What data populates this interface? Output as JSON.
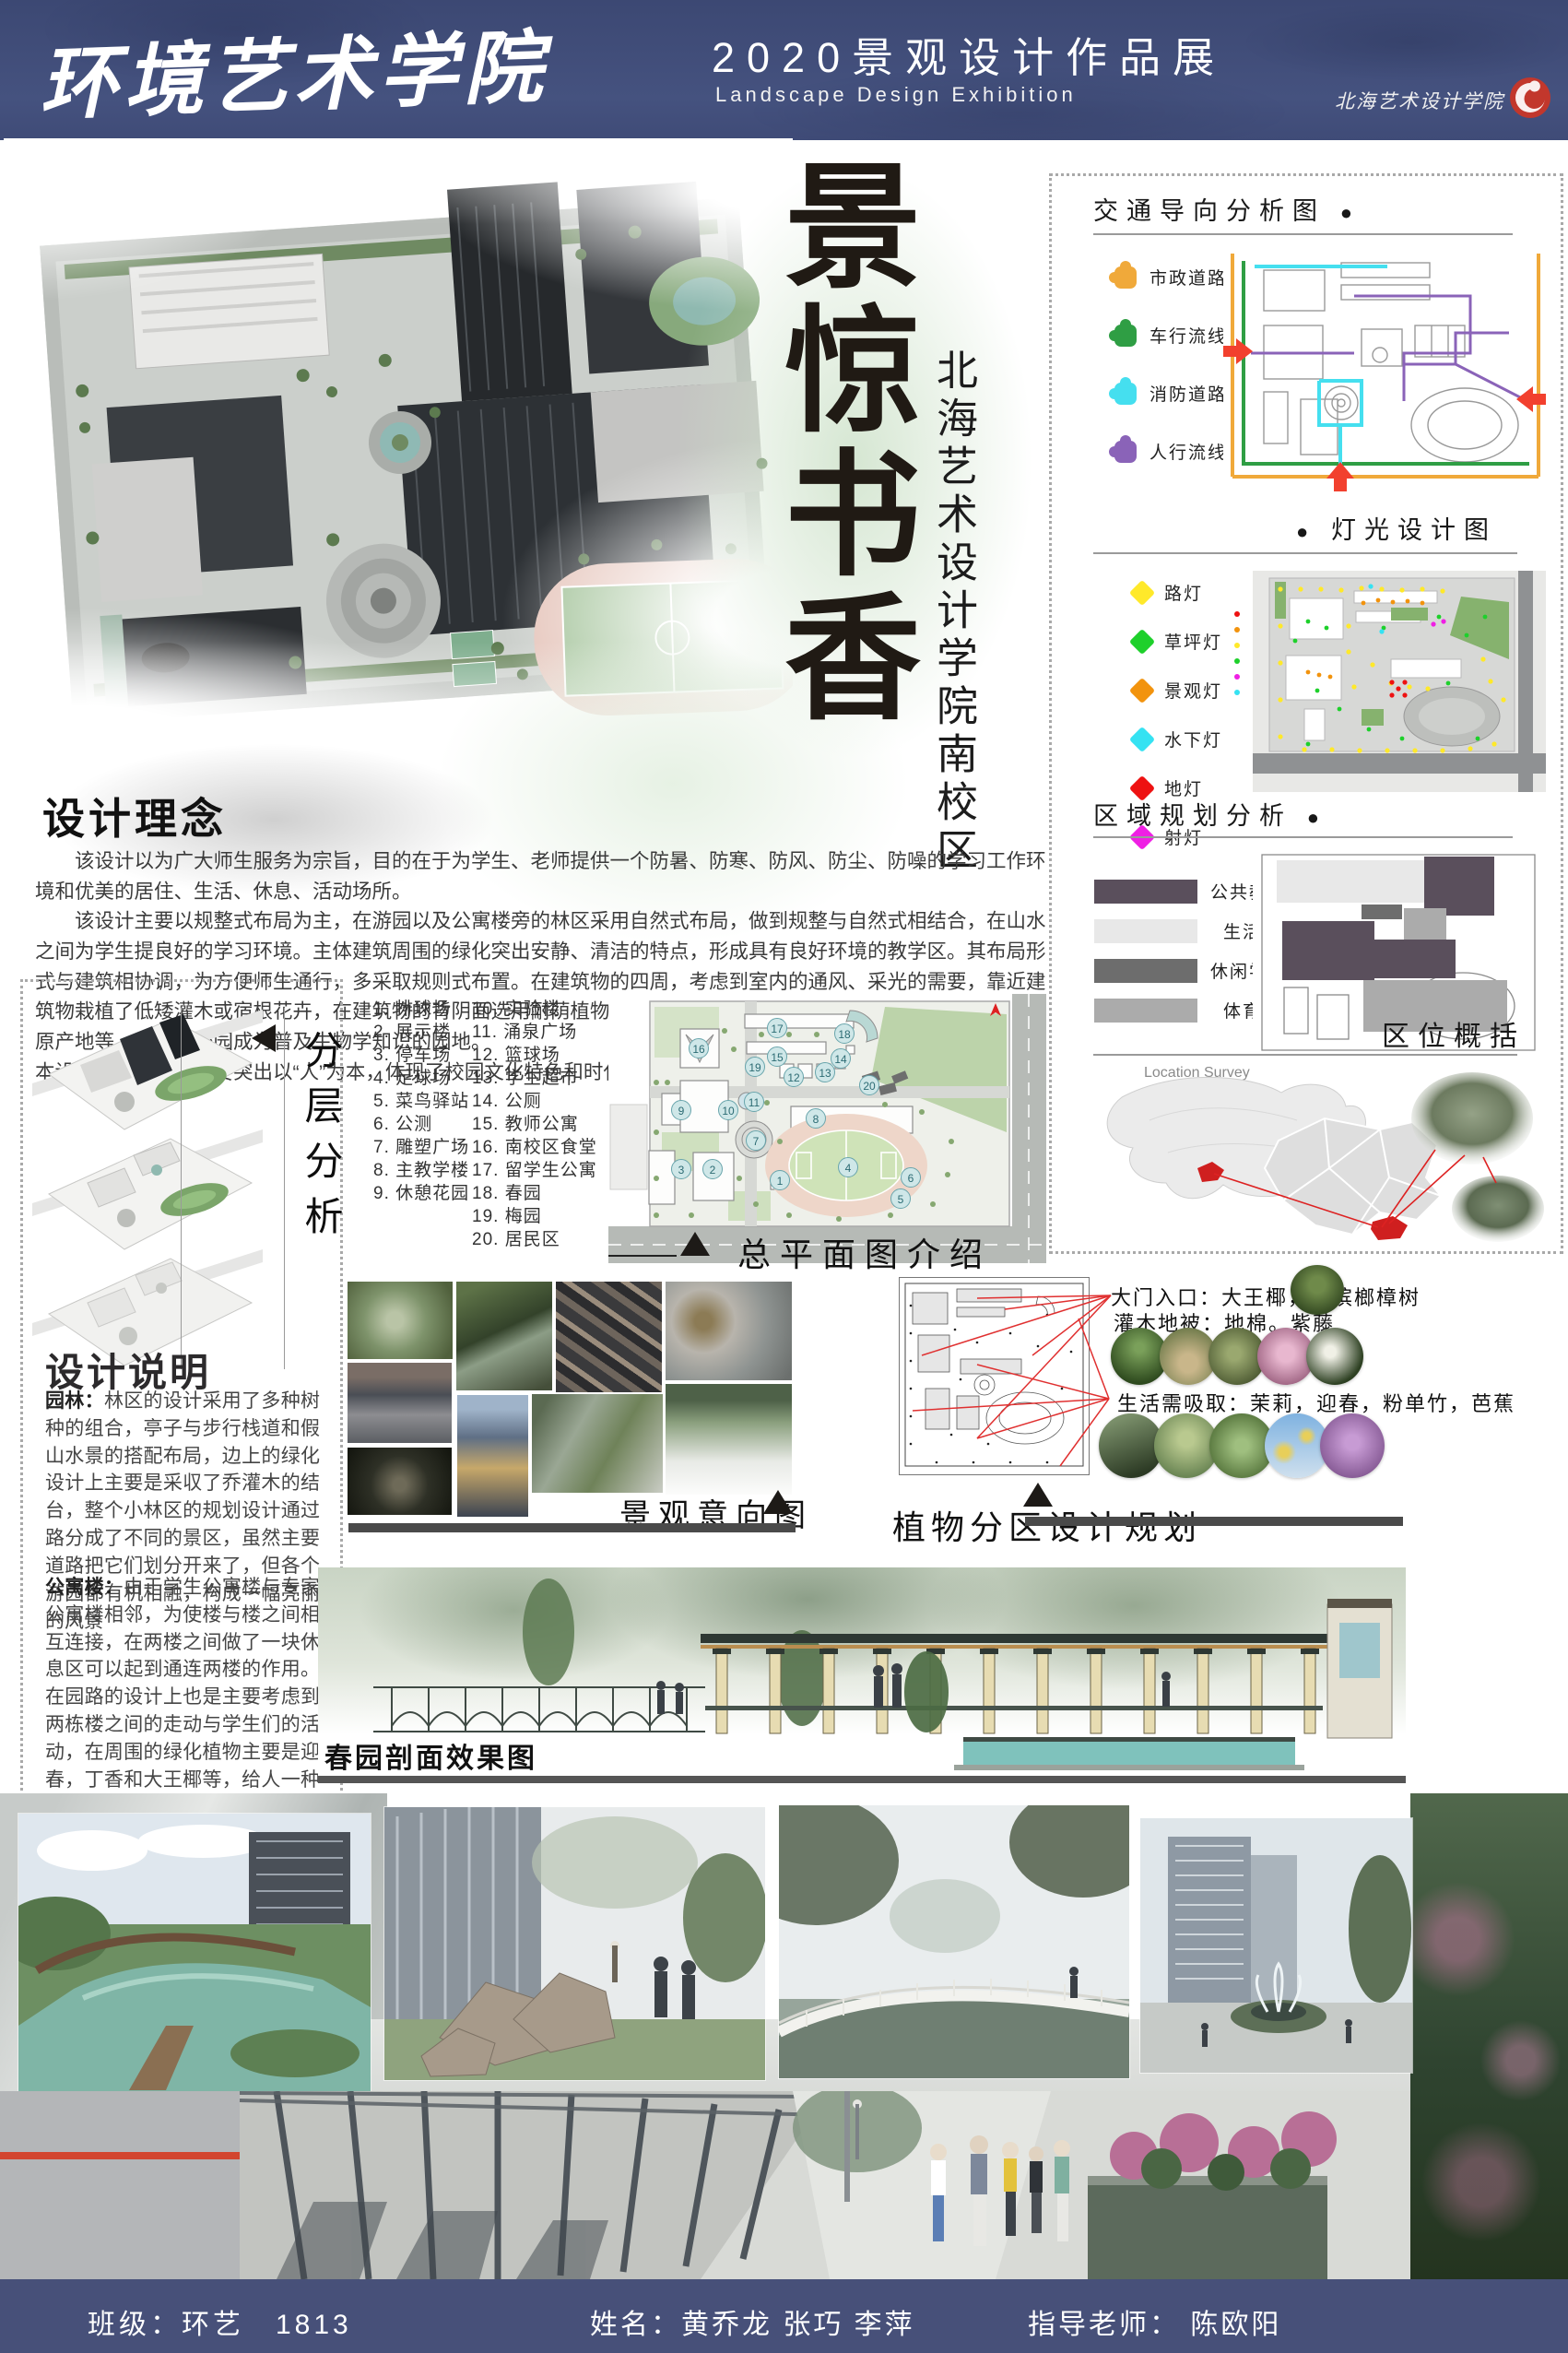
{
  "header": {
    "school_title": "环境艺术学院",
    "exhibition_title": "2020景观设计作品展",
    "exhibition_subtitle": "Landscape Design Exhibition",
    "logo_text": "北海艺术设计学院"
  },
  "hero": {
    "calligraphy_title": "景惊书香",
    "campus_subtitle": "北海艺术设计学院南校区"
  },
  "analysis_panel": {
    "traffic": {
      "title": "交通导向分析图",
      "bullet": "●",
      "legend": [
        {
          "label": "市政道路",
          "color": "#f0a93a"
        },
        {
          "label": "车行流线",
          "color": "#2f9e44"
        },
        {
          "label": "消防道路",
          "color": "#45dfef"
        },
        {
          "label": "人行流线",
          "color": "#8a63b8"
        }
      ]
    },
    "lighting": {
      "title": "灯光设计图",
      "bullet": "●",
      "legend": [
        {
          "label": "路灯",
          "color": "#ffe92a"
        },
        {
          "label": "草坪灯",
          "color": "#1ed02b"
        },
        {
          "label": "景观灯",
          "color": "#f2930d"
        },
        {
          "label": "水下灯",
          "color": "#35e2f2"
        },
        {
          "label": "地灯",
          "color": "#ee1111"
        },
        {
          "label": "射灯",
          "color": "#ef1fe4"
        }
      ]
    },
    "zoning": {
      "title": "区域规划分析",
      "bullet": "●",
      "legend": [
        {
          "label": "公共教学区",
          "color": "#5a4f5c"
        },
        {
          "label": "生活区",
          "color": "#e8e8e8"
        },
        {
          "label": "休闲学习区",
          "color": "#6d6d6d"
        },
        {
          "label": "体育区",
          "color": "#ababab"
        }
      ]
    },
    "location": {
      "title": "区位概括",
      "survey_label": "Location Survey"
    }
  },
  "design_concept": {
    "title": "设计理念",
    "paragraphs": [
      "该设计以为广大师生服务为宗旨，目的在于为学生、老师提供一个防暑、防寒、防风、防尘、防噪的学习工作环境和优美的居住、生活、休息、活动场所。",
      "该设计主要以规整式布局为主，在游园以及公寓楼旁的林区采用自然式布局，做到规整与自然式相结合，在山水之间为学生提良好的学习环境。主体建筑周围的绿化突出安静、清洁的特点，形成具有良好环境的教学区。其布局形式与建筑相协调，为方便师生通行，多采取规则式布置。在建筑物的四周，考虑到室内的通风、采光的需要，靠近建筑物栽植了低矮灌木或宿根花卉，在建筑物的背阴面选用耐荫植物。园内树种丰富，并挂牌标明树种的名称、特性、原产地等，使整个校园成为普及生物学知识的园地。",
      "本设计中设计理念主要突出以“人”为本，体现了校园文化特色和时代特色。"
    ]
  },
  "layered_analysis": {
    "title": "分层分析"
  },
  "facilities": {
    "col1": [
      "1. 排球场",
      "2. 展示楼",
      "3. 停车场",
      "4. 足球场",
      "5. 菜鸟驿站",
      "6. 公测",
      "7. 雕塑广场",
      "8. 主教学楼",
      "9. 休憩花园"
    ],
    "col2": [
      "10. 实验楼",
      "11. 涌泉广场",
      "12. 篮球场",
      "13. 学生超市",
      "14. 公厕",
      "15. 教师公寓",
      "16. 南校区食堂",
      "17. 留学生公寓",
      "18. 春园",
      "19. 梅园",
      "20. 居民区"
    ]
  },
  "master_plan": {
    "title": "总平面图介绍",
    "plan_markers": [
      "1",
      "2",
      "3",
      "4",
      "5",
      "6",
      "7",
      "8",
      "9",
      "10",
      "11",
      "12",
      "13",
      "14",
      "15",
      "16",
      "17",
      "18",
      "19",
      "20"
    ]
  },
  "design_description": {
    "title": "设计说明",
    "garden_heading": "园林：",
    "garden_text": "林区的设计采用了多种树种的组合，亭子与步行栈道和假山水景的搭配布局，边上的绿化设计上主要是采収了乔灌木的结台，整个小林区的规划设计通过路分成了不同的景区，虽然主要道路把它们划分开来了，但各个游园都有机相融，构成一幅亮丽的风景",
    "apartment_heading": "公寓楼：",
    "apartment_text": "由于学生公寓楼与专家公寓楼相邻，为使楼与楼之间相互连接，在两楼之间做了一块休息区可以起到通连两楼的作用。在园路的设计上也是主要考虑到两栋楼之间的走动与学生们的活动，在周围的绿化植物主要是迎春，丁香和大王椰等，给人一种花香四溢的感觉。"
  },
  "landscape_intent": {
    "title": "景观意向图"
  },
  "plant_zoning": {
    "title": "植物分区设计规划",
    "entrance_line": "大门入口：大王椰，假槟榔樟树",
    "shrub_line": "灌木地被：地棉。紫藤",
    "living_line": "生活需吸取：茉莉，迎春，粉单竹，芭蕉"
  },
  "section_view": {
    "title": "春园剖面效果图"
  },
  "footer": {
    "class_label": "班级：环艺　1813",
    "names_label": "姓名：黄乔龙 张巧 李萍",
    "advisor_label": "指导老师： 陈欧阳"
  }
}
